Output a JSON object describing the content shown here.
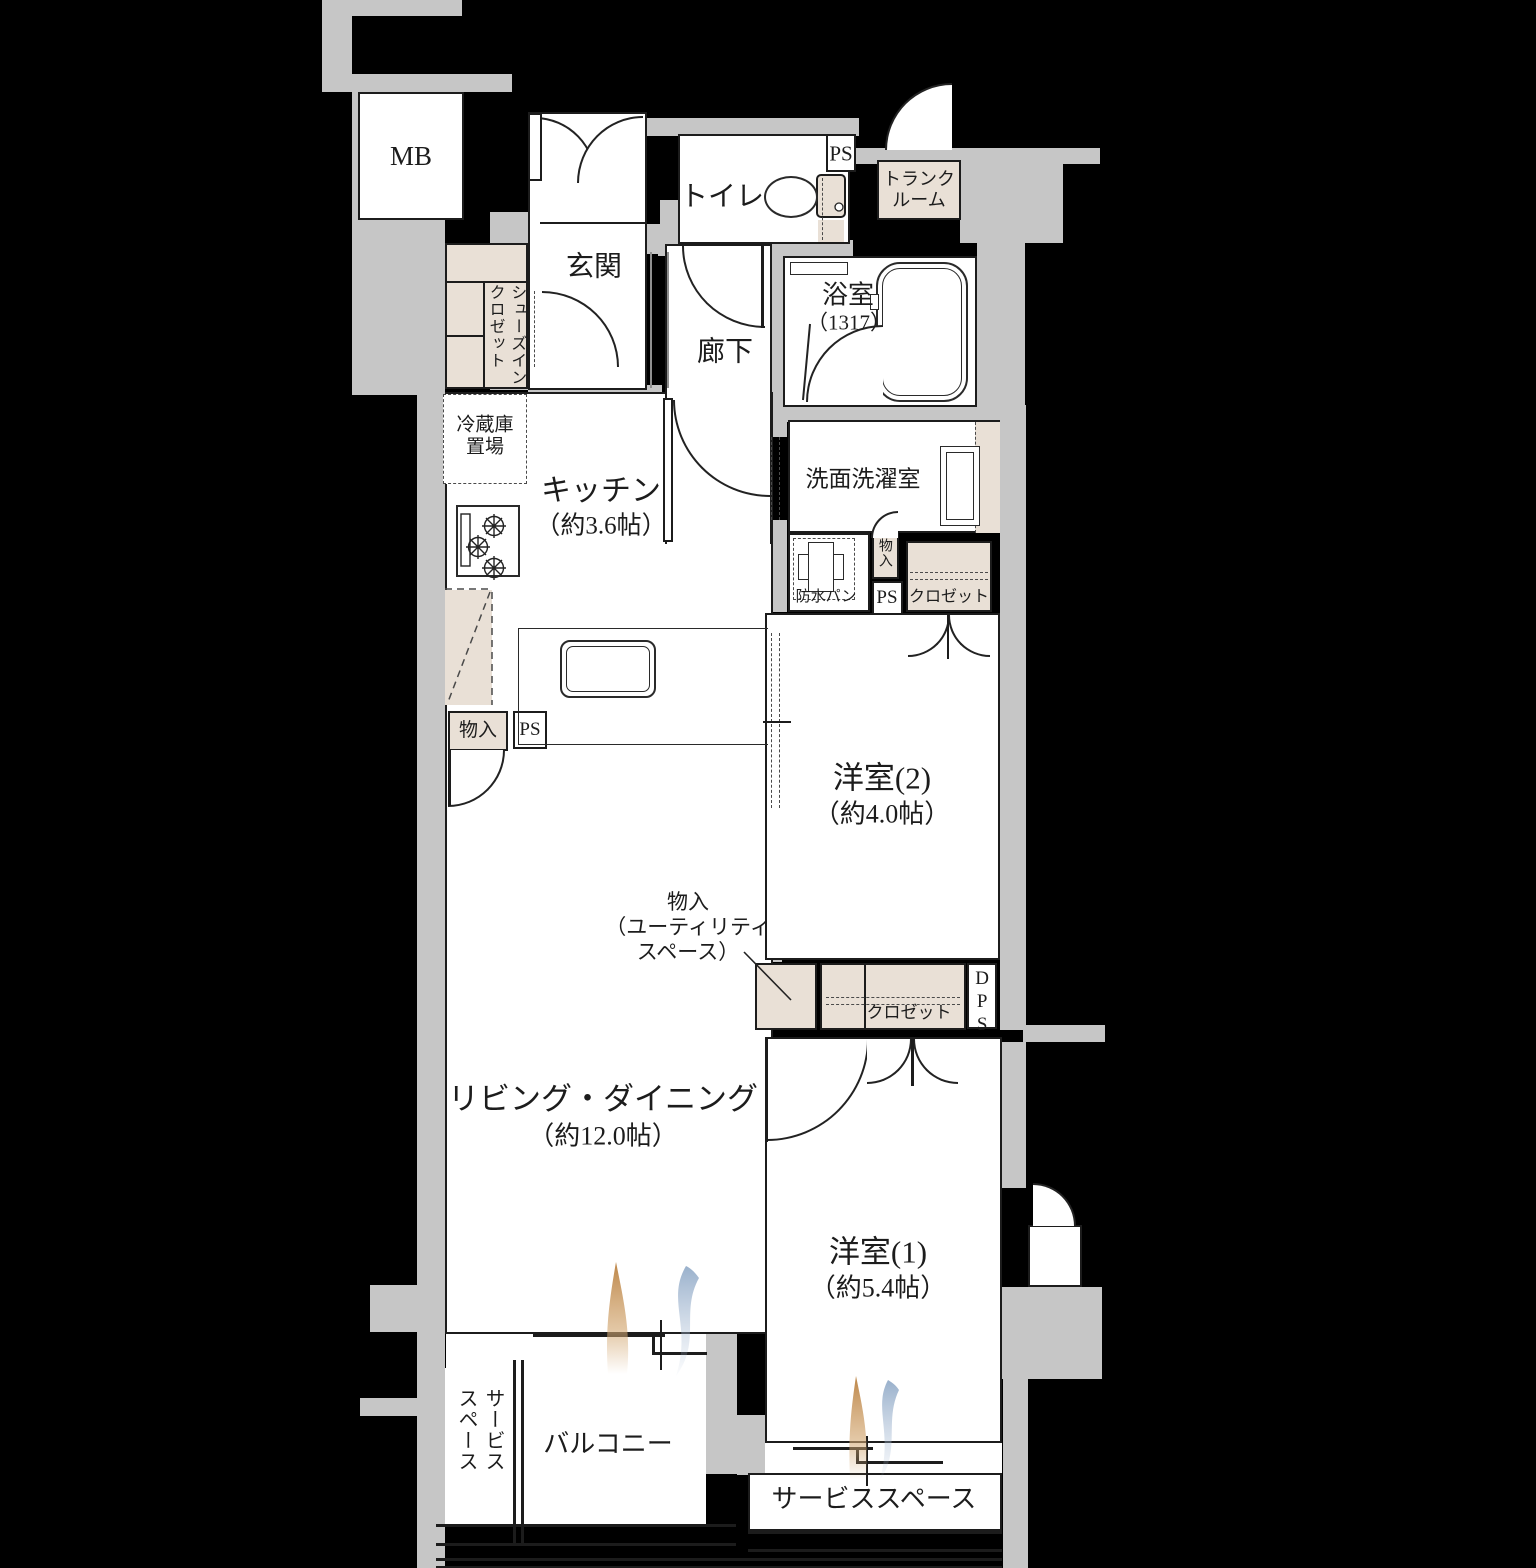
{
  "floorplan": {
    "rooms": {
      "entrance": "玄関",
      "toilet": "トイレ",
      "corridor": "廊下",
      "washroom": "洗面洗濯室",
      "balcony": "バルコニー",
      "bath": {
        "name": "浴室",
        "size": "（1317）"
      },
      "kitchen": {
        "name": "キッチン",
        "size": "（約3.6帖）"
      },
      "living": {
        "name": "リビング・ダイニング",
        "size": "（約12.0帖）"
      },
      "western1": {
        "name": "洋室(1)",
        "size": "（約5.4帖）"
      },
      "western2": {
        "name": "洋室(2)",
        "size": "（約4.0帖）"
      },
      "trunk": "トランク\nルーム",
      "service_left": "サービス\nスペース",
      "service_bottom": "サービススペース"
    },
    "storage": {
      "shoes_closet": "シューズイン\nクロゼット",
      "closet_mid": "クロゼット",
      "closet_low": "クロゼット",
      "storage_wash": "物入",
      "storage_kitchen": "物入",
      "storage_utility": "物入\n（ユーティリティ\nスペース）",
      "fridge": "冷蔵庫\n置場",
      "waterproof_pan": "防水パン"
    },
    "shafts": {
      "mb": "MB",
      "ps_toilet": "PS",
      "ps_washroom": "PS",
      "ps_kitchen": "PS",
      "dps": "DPS"
    },
    "colors": {
      "background": "#000000",
      "wall": "#c6c6c6",
      "line": "#1c1c1c",
      "closet_fill": "#e9e0d6",
      "flame_orange": "#c08848",
      "flame_blue": "#8ea8c6"
    }
  }
}
